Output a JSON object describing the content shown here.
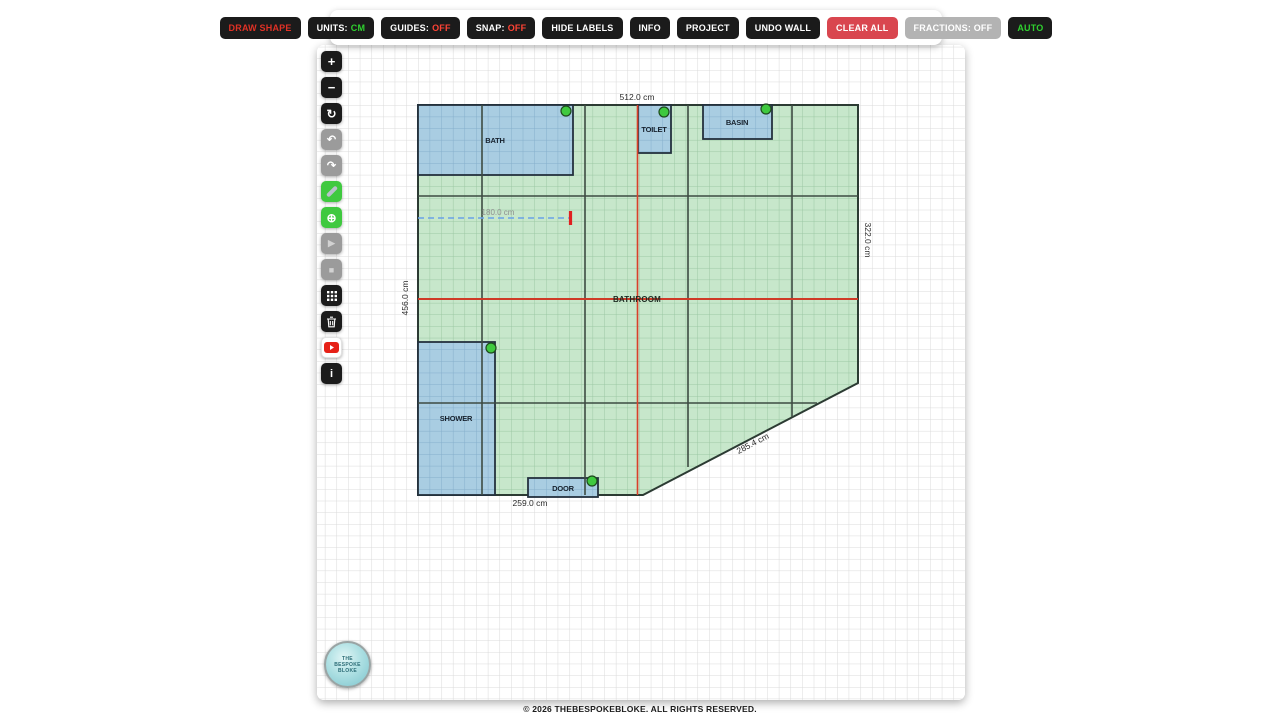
{
  "top_toolbar": {
    "draw_shape": "DRAW SHAPE",
    "units_label": "UNITS:",
    "units_value": "CM",
    "guides_label": "GUIDES:",
    "guides_value": "OFF",
    "snap_label": "SNAP:",
    "snap_value": "OFF",
    "hide_labels": "HIDE LABELS",
    "info": "INFO",
    "project": "PROJECT",
    "undo_wall": "UNDO WALL",
    "clear_all": "CLEAR ALL",
    "fractions": "FRACTIONS: OFF",
    "auto": "AUTO"
  },
  "side_toolbar": {
    "zoom_in": "+",
    "zoom_out": "−",
    "rotate": "↻",
    "undo": "↶",
    "redo": "↷",
    "target": "⊕",
    "play": "▶",
    "stop": "■",
    "info": "i"
  },
  "plan": {
    "room_label": "BATHROOM",
    "units": "cm",
    "dim_top": "512.0 cm",
    "dim_left": "456.0 cm",
    "dim_right": "322.0 cm",
    "dim_bottom": "259.0 cm",
    "dim_diagonal": "285.4 cm",
    "guide_length": "180.0 cm",
    "fixtures": {
      "bath": "BATH",
      "toilet": "TOILET",
      "basin": "BASIN",
      "shower": "SHOWER",
      "door": "DOOR"
    }
  },
  "logo": {
    "line1": "THE",
    "line2": "BESPOKE",
    "line3": "BLOKE"
  },
  "footer": {
    "copyright": "© 2026 THEBESPOKEBLOKE. ALL RIGHTS RESERVED."
  },
  "colors": {
    "room_fill": "#c7e7cb",
    "room_grid": "#9bc7a3",
    "fixture_fill": "#a9cde2",
    "fixture_grid": "#84aecb",
    "wall": "#3d4b42",
    "guide_red": "#d9402b",
    "guide_blue": "#6aa2e8",
    "handle_green": "#3fc93f",
    "accent_red": "#d9464f",
    "accent_green": "#2fd12f"
  }
}
